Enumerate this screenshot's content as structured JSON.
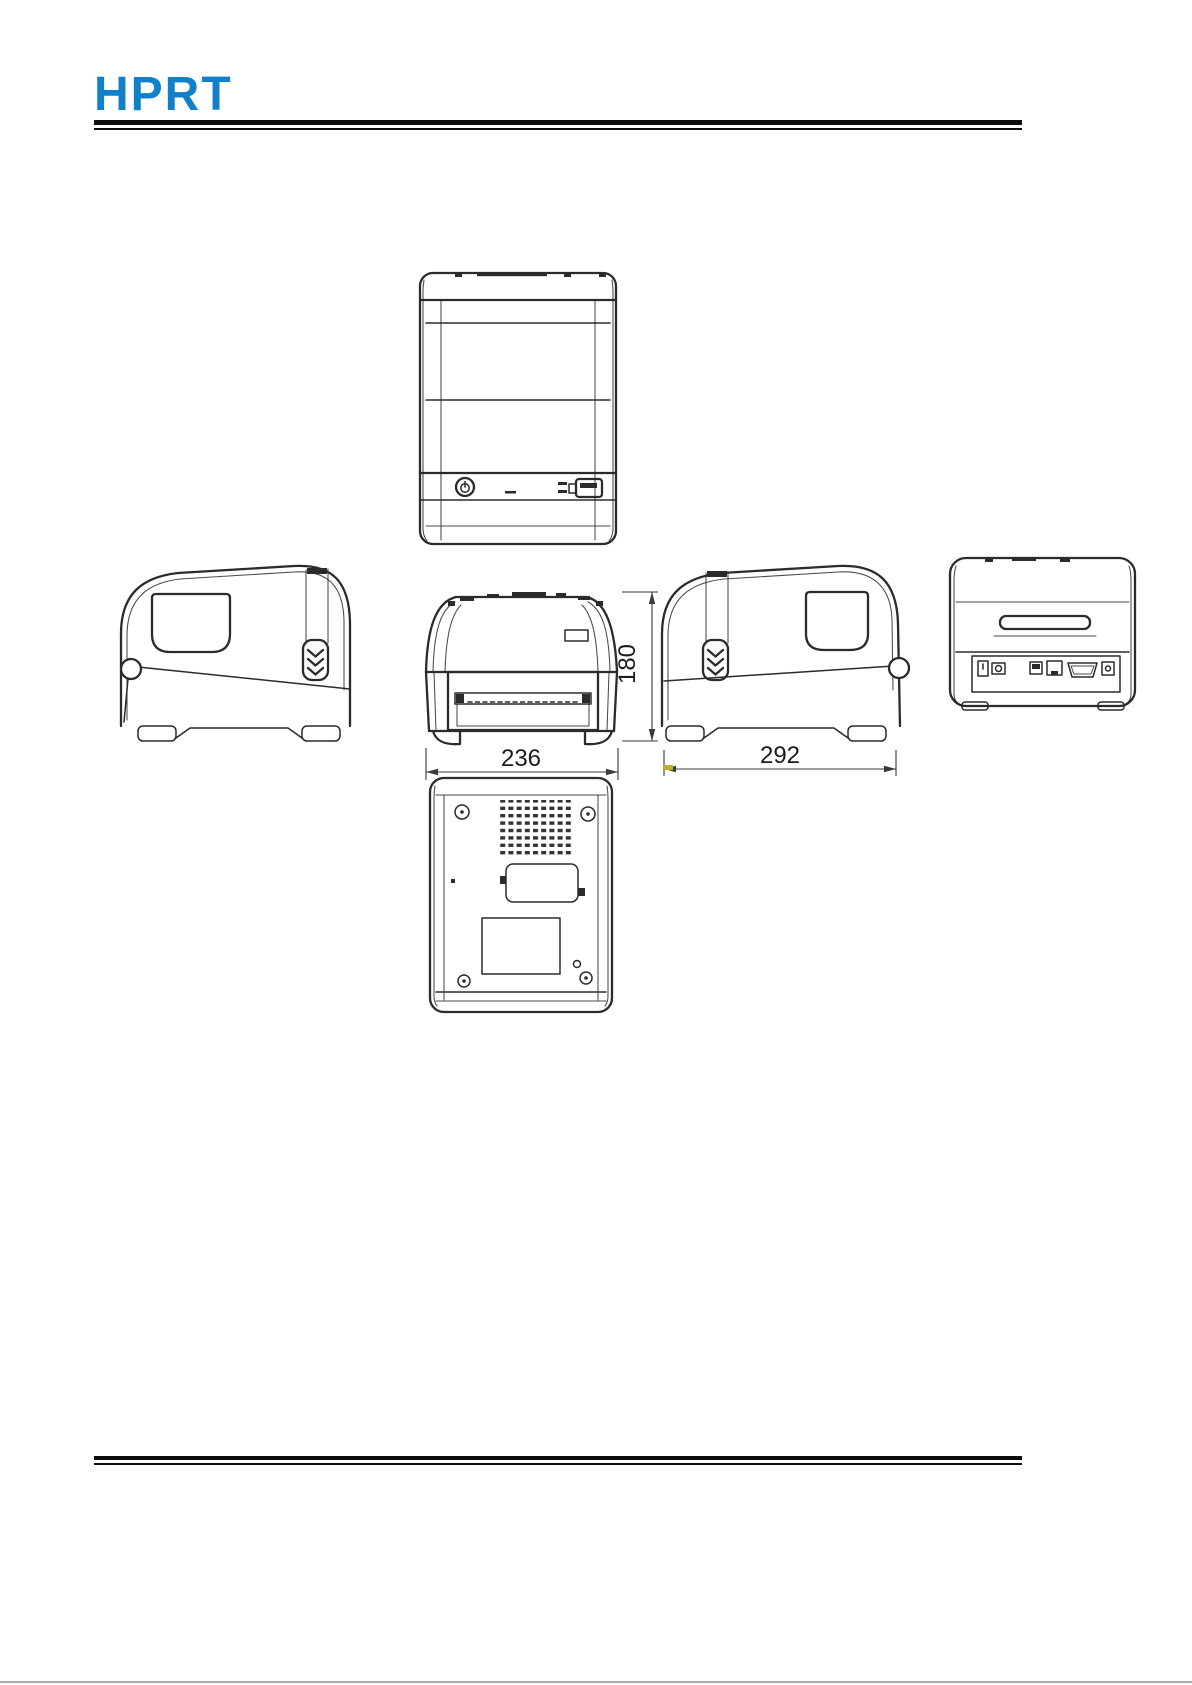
{
  "page": {
    "width": 1192,
    "height": 1685,
    "background": "#ffffff"
  },
  "header": {
    "logo_text": "HPRT",
    "logo_color": "#1080c8"
  },
  "figure": {
    "dimensions": {
      "front_width": "236",
      "side_depth": "292",
      "body_height": "180"
    },
    "accent_tick_color": "#c0ae2a"
  }
}
